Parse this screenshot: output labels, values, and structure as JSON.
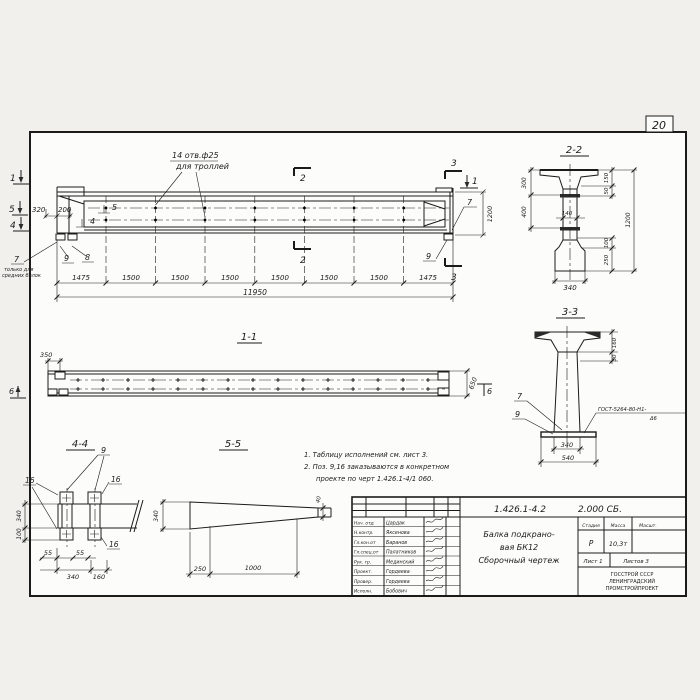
{
  "page": {
    "number": "20"
  },
  "main_view": {
    "hole_note_line1": "14 отв.ф25",
    "hole_note_line2": "для троллей",
    "dim_320": "320",
    "dim_200": "200",
    "pos_5": "5",
    "pos_4": "4",
    "cut_1_left": "1",
    "cut_5_left": "5",
    "cut_4_left": "4",
    "pos_7_left": "7",
    "pos_7_note_line1": "только для",
    "pos_7_note_line2": "средних балок",
    "pos_9_left": "9",
    "pos_8": "8",
    "cut_2_top": "2",
    "cut_2_bottom": "2",
    "cut_3_top": "3",
    "cut_3_bottom": "3",
    "cut_1_right": "1",
    "pos_7_right": "7",
    "pos_9_right": "9",
    "dim_1200": "1200",
    "bottom_dims": [
      "1475",
      "1500",
      "1500",
      "1500",
      "1500",
      "1500",
      "1500",
      "1475"
    ],
    "dim_total": "11950"
  },
  "section_2_2": {
    "title": "2-2",
    "dim_300": "300",
    "dim_400": "400",
    "dim_140": "140",
    "dim_150": "150",
    "dim_50": "50",
    "dim_1200": "1200",
    "dim_100": "100",
    "dim_250": "250",
    "dim_340": "340"
  },
  "section_3_3": {
    "title": "3-3",
    "dim_160": "160",
    "dim_30": "30",
    "dim_340": "340",
    "dim_540": "540",
    "pos_7": "7",
    "pos_9": "9",
    "weld_note_line1": "ГОСТ-5264-80-Н1-",
    "weld_note_line2": "Δ6"
  },
  "section_1_1": {
    "title": "1-1",
    "dim_350": "350",
    "dim_650": "650",
    "cut_6_left": "6",
    "cut_6_right": "6"
  },
  "section_4_4": {
    "title": "4-4",
    "pos_9": "9",
    "pos_16_left": "16",
    "pos_16_right": "16",
    "pos_16_bottom": "16",
    "dim_340_left": "340",
    "dim_100": "100",
    "dim_55_a": "55",
    "dim_55_b": "55",
    "dim_340_bottom": "340",
    "dim_160": "160"
  },
  "section_5_5": {
    "title": "5-5",
    "dim_340": "340",
    "dim_250": "250",
    "dim_1000": "1000",
    "dim_40": "40"
  },
  "notes": {
    "line1": "1. Таблицу исполнений см. лист 3.",
    "line2": "2. Поз. 9,16 заказываются в конкретном",
    "line3": "проекте по черт 1.426.1-4/1 060."
  },
  "title_block": {
    "doc_number": "1.426.1-4.2",
    "doc_code": "2.000 СБ.",
    "product_line1": "Балка подкрано-",
    "product_line2": "вая БК12",
    "product_line3": "Сборочный чертеж",
    "stage_header": "Стадия",
    "mass_header": "Масса",
    "scale_header": "Масшт.",
    "stage_value": "Р",
    "mass_value": "10,3т",
    "sheet_label": "Лист 1",
    "sheets_label": "Листов 3",
    "org_line1": "ГОССТРОЙ СССР",
    "org_line2": "ЛЕНИНГРАДСКИЙ",
    "org_line3": "ПРОМСТРОЙПРОЕКТ",
    "roles": [
      {
        "role": "Нач. отд",
        "name": "Цардак"
      },
      {
        "role": "Н.контр.",
        "name": "Яксенова"
      },
      {
        "role": "Гл.кон.от",
        "name": "Баранов"
      },
      {
        "role": "Гл.спец.от",
        "name": "Палатников"
      },
      {
        "role": "Рук. гр.",
        "name": "Мединский"
      },
      {
        "role": "Проект.",
        "name": "Гордеева"
      },
      {
        "role": "Провер.",
        "name": "Гордеева"
      },
      {
        "role": "Исполн.",
        "name": "Бобович"
      }
    ]
  }
}
